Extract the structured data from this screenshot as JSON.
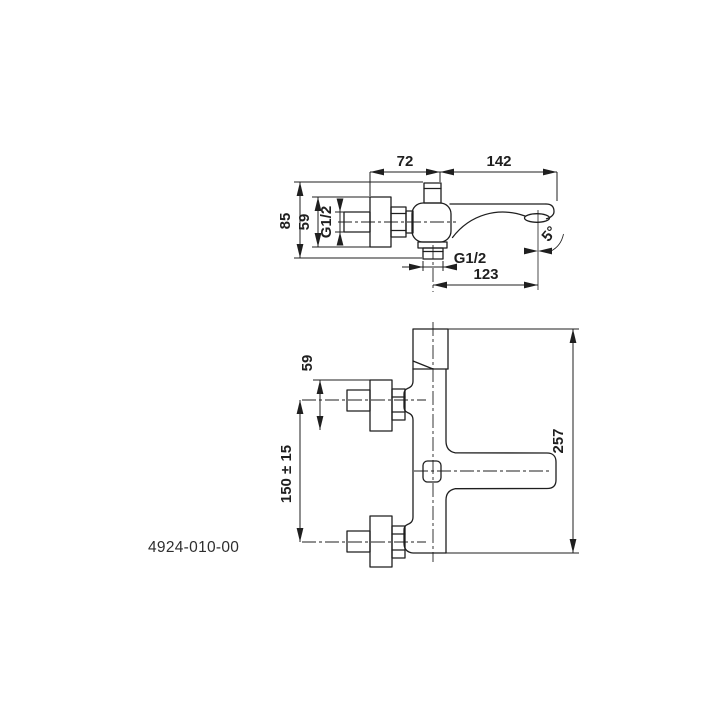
{
  "page": {
    "background": "#ffffff",
    "line_color": "#1f1f1f"
  },
  "product_code": "4924-010-00",
  "top_view": {
    "dim_width_left": "72",
    "dim_width_right": "142",
    "dim_depth_total": "85",
    "dim_depth_flange": "59",
    "dim_thread_side": "G1/2",
    "dim_thread_bottom": "G1/2",
    "dim_spout_reach": "123",
    "dim_spout_angle": "5°"
  },
  "front_view": {
    "dim_flange_height": "59",
    "dim_mounting_distance": "150 ± 15",
    "dim_total_height": "257"
  }
}
